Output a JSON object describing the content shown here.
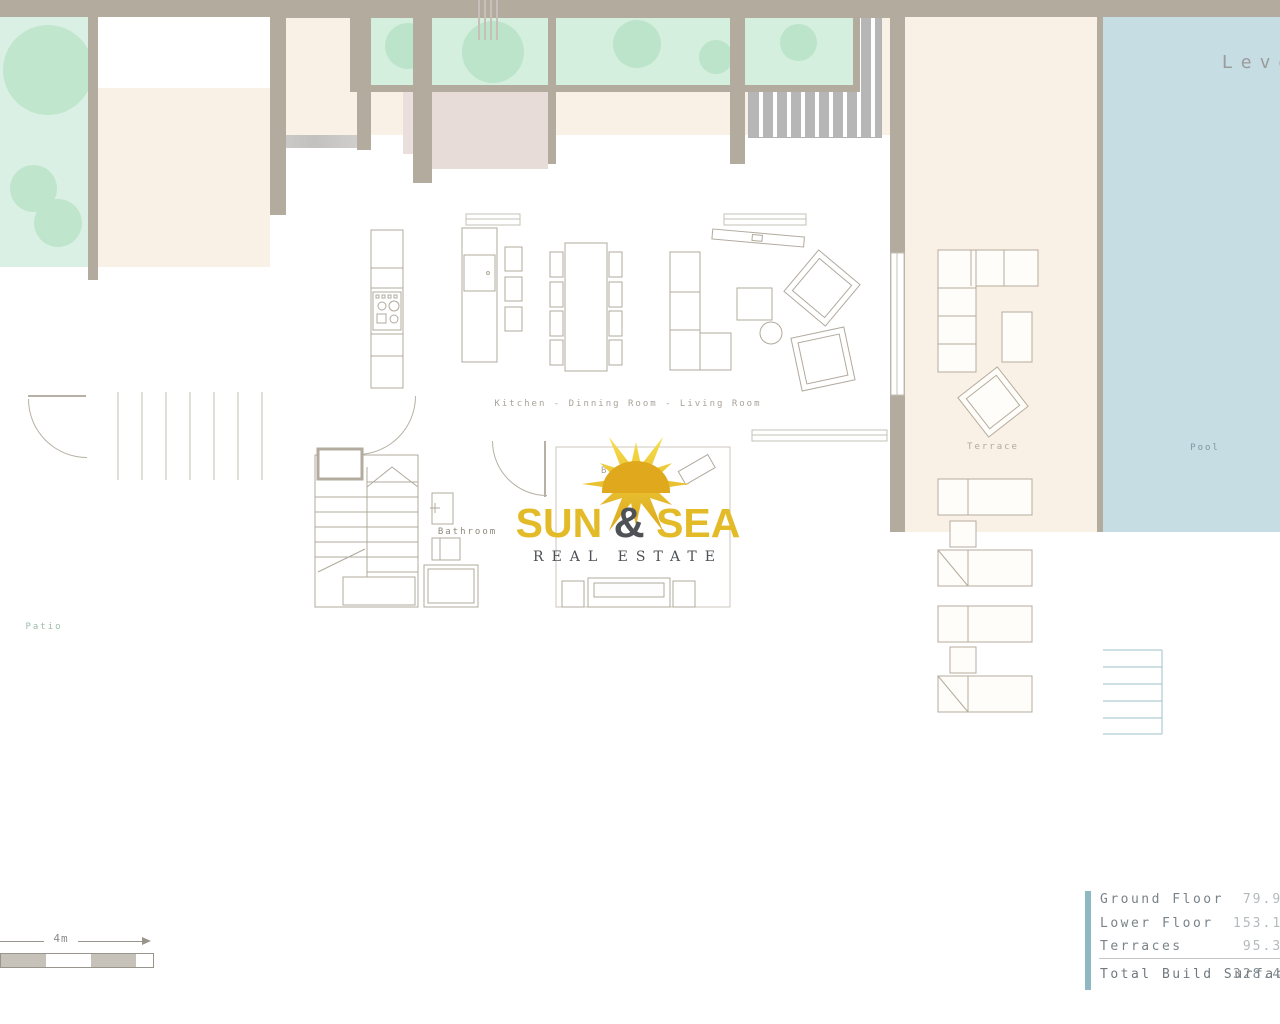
{
  "header": {
    "level": "Level"
  },
  "labels": {
    "kitchen": "Kitchen - Dinning Room - Living Room",
    "bathroom": "Bathroom",
    "bedroom": "Bedroom",
    "terrace": "Terrace",
    "pool": "Pool",
    "patio": "Patio"
  },
  "logo": {
    "word1": "SUN",
    "amp": "&",
    "word2": "SEA",
    "tagline": "REAL ESTATE",
    "gold_color": "#e3ba27",
    "dark_color": "#4e5156"
  },
  "scale_bar": {
    "label": "4m"
  },
  "legend": {
    "accent_color": "#8fb9c2",
    "rows": [
      {
        "label": "Ground Floor",
        "value": "79.95"
      },
      {
        "label": "Lower Floor",
        "value": "153.18"
      },
      {
        "label": "Terraces",
        "value": "95.38"
      }
    ],
    "total_label": "Total Build Surface",
    "total_value": "328.49"
  }
}
